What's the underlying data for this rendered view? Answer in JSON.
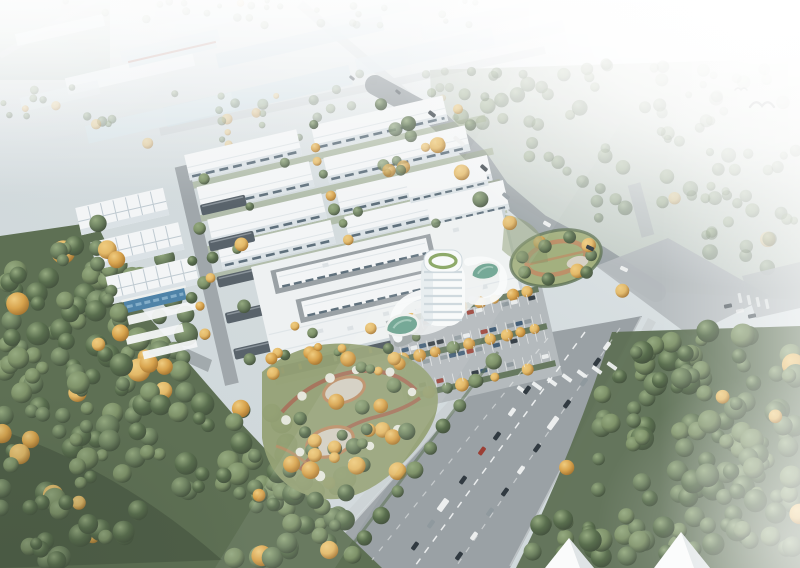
{
  "scene": {
    "type": "aerial-architectural-rendering",
    "subject": "Bird's-eye architectural rendering of an industrial park campus: rows of white warehouse factories, a large mega-roof headquarters building with courtyard slots, a round white office tower with green pools, tree-lined parking, landscaped gardens with orange autumn trees, a diagonal boulevard with traffic, dense forests and bright haze",
    "labels": {
      "distant-district": "hazy distant industrial district",
      "warehouse-rows": "rows of standard white factory buildings",
      "grid-roof-buildings": "workshop buildings with gridded skylight roofs",
      "glass-strip": "blue glass strip attached to workshop",
      "carport-canopies": "dark parking canopies",
      "hq-building": "main factory hall with continuous white mega roof",
      "courtyard-buildings": "long window-banded buildings inside roof openings",
      "office-tower": "round white office tower with balcony bands",
      "landscape-pools": "kidney-shaped green pools on podium",
      "parking-lot": "surface parking with planted strips and cars",
      "northeast-garden": "oval garden with ring path",
      "southwest-garden": "organic garden with loop paths, gravel ovals and flowering shrubs",
      "boulevard": "wide boulevard running to bottom edge with traffic",
      "boundary-road": "curved boundary road along north-east edge",
      "intersection": "large road intersection in haze",
      "forest-left": "dense forest, lower left",
      "forest-right": "dense hazy forest, right side",
      "gable-buildings": "white gable rooftops at bottom tree line",
      "birds": "flying birds in haze"
    }
  },
  "palette": {
    "haze": "#ffffff",
    "sky_top": "#eef2f3",
    "ground": "#ccd5d8",
    "ground_light": "#e7edee",
    "distant_field": "#b7c7c1",
    "road_distant": "#c9d0d3",
    "road_main": "#9aa1a5",
    "road_light": "#b6bcbf",
    "road_edge": "#c6cbcd",
    "marking": "#f4f6f6",
    "forest_base": "#5e7054",
    "forest_dark": "#41503c",
    "tree_g1": "#6d8160",
    "tree_g2": "#596e4e",
    "tree_g3": "#7e9269",
    "tree_g_hi": "#95aa80",
    "tree_g_sh": "#44523e",
    "tree_a1": "#d8a44e",
    "tree_a2": "#e3b968",
    "tree_a_hi": "#efcc80",
    "tree_a_sh": "#a57430",
    "lawn": "#a3b07f",
    "lawn_dark": "#8a9a6e",
    "hedge": "#5e7255",
    "path_tan": "#bd9069",
    "path_red": "#a8705b",
    "flower": "#e9ebe2",
    "gravel": "#d3cfc2",
    "roof_white": "#f3f5f6",
    "roof_big": "#eef1f2",
    "roof_shadow": "#c9d2d7",
    "roof_seam": "#dfe5e8",
    "roof_red": "#b0766a",
    "face_light": "#dbe2e6",
    "face_dark": "#4d575e",
    "window_dark": "#5f707c",
    "canopy": "#59636b",
    "canopy_hi": "#8b949b",
    "grid_line": "#bfcad1",
    "water": "#4f83a8",
    "water_hi": "#84aec9",
    "pool": "#6ca390",
    "pool_hi": "#9fc6b6",
    "deck": "#eef0ee",
    "tower_white": "#f8fafa",
    "tower_band": "#ccd7dc",
    "tower_shade": "#dfe7ea",
    "tower_green": "#86a45f",
    "plaza": "#d7d2c6",
    "asphalt": "#b4babd",
    "stall_line": "#e8eaea",
    "gable": "#fafbfb",
    "gable_shade": "#d5dcdf",
    "bird": "#3a4045",
    "car_dark": "#313a41",
    "car_white": "#eceeee",
    "car_grey": "#8f999e",
    "car_red": "#9c3f35",
    "car_blue": "#3e5a74"
  },
  "distant_roof_colors": [
    "#e6ebee",
    "#c9d9e0",
    "#c3d5dd",
    "#cfdde4",
    "#d2e0e5",
    "#dfe7ea",
    "#d5e1e6",
    "#cfdce2",
    "#d8e2e6",
    "#dae4e8"
  ],
  "facade_accent_colors": [
    "#c96c3f",
    "#d8a04b",
    "#b34a3c",
    "#dfe3e4"
  ]
}
